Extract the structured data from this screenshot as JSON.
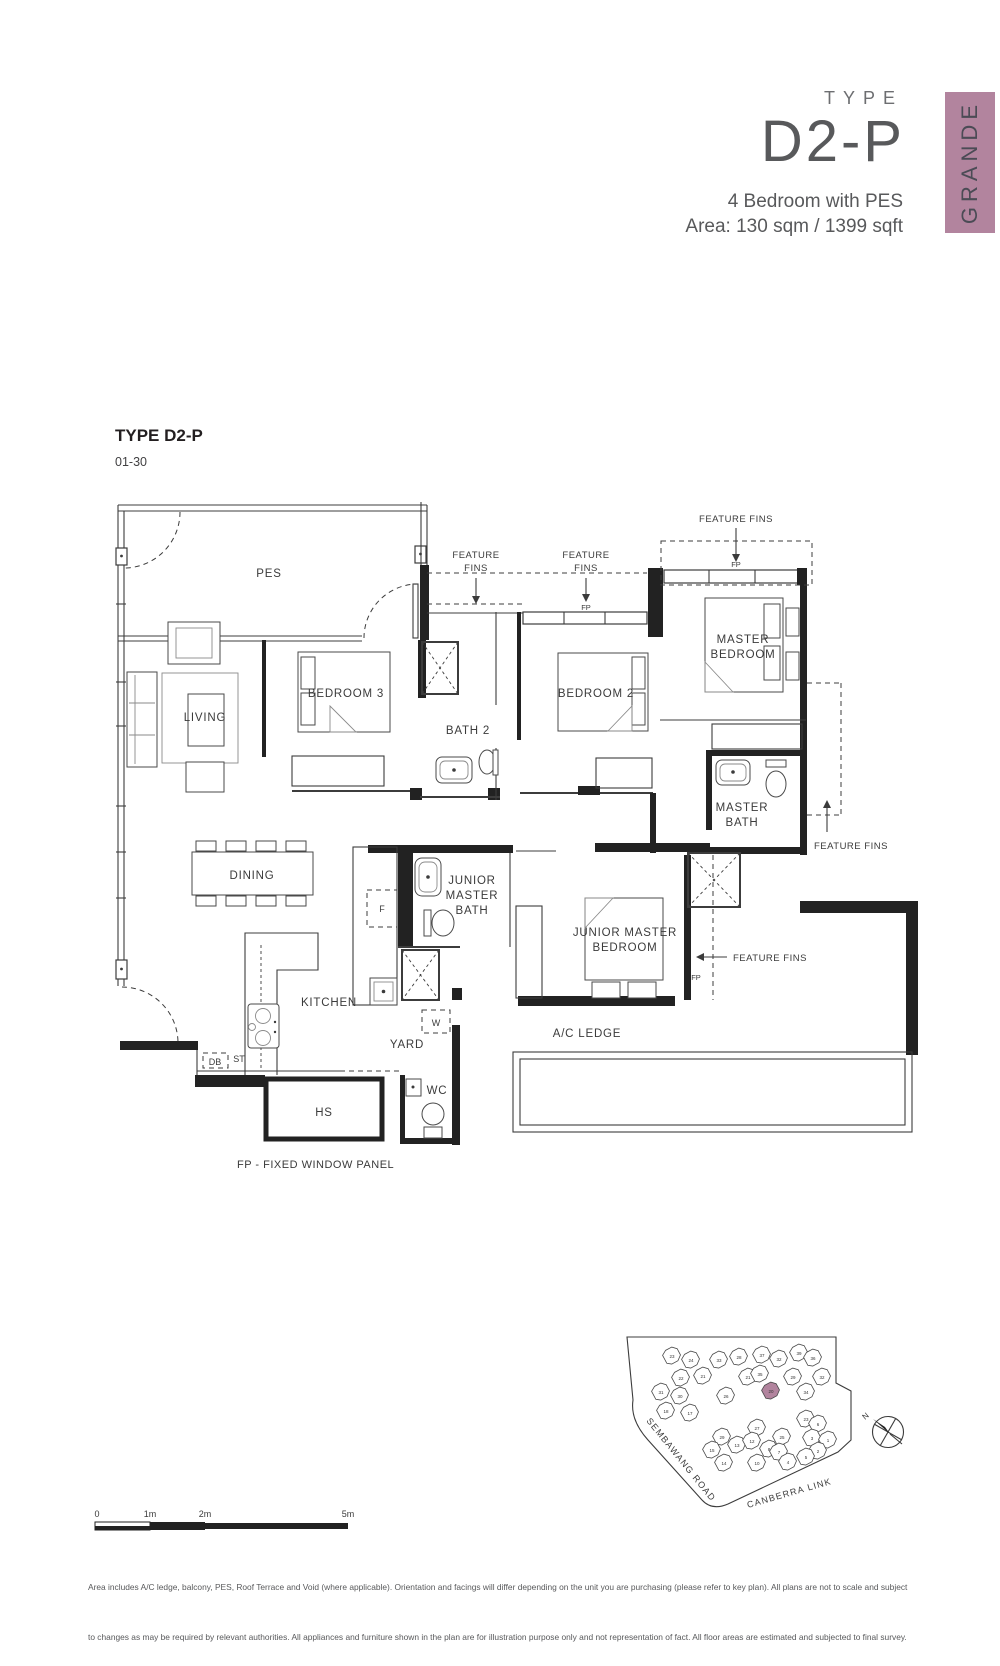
{
  "header": {
    "type_label": "TYPE",
    "unit_type": "D2-P",
    "subtitle": "4 Bedroom with PES",
    "area": "Area: 130 sqm / 1399 sqft",
    "brand": "GRANDE",
    "accent_color": "#b2849e"
  },
  "plan": {
    "title": "TYPE D2-P",
    "floors": "01-30",
    "note": "FP - FIXED WINDOW PANEL",
    "rooms": {
      "pes": "PES",
      "living": "LIVING",
      "dining": "DINING",
      "bedroom3": "BEDROOM 3",
      "bath2": "BATH 2",
      "bedroom2": "BEDROOM 2",
      "master_1": "MASTER",
      "master_2": "BEDROOM",
      "master_bath_1": "MASTER",
      "master_bath_2": "BATH",
      "jr_bath_1": "JUNIOR",
      "jr_bath_2": "MASTER",
      "jr_bath_3": "BATH",
      "jr_bed_1": "JUNIOR MASTER",
      "jr_bed_2": "BEDROOM",
      "kitchen": "KITCHEN",
      "yard": "YARD",
      "ac_ledge": "A/C LEDGE",
      "wc": "WC",
      "hs": "HS"
    },
    "tags": {
      "fp": "FP",
      "f": "F",
      "w": "W",
      "st": "ST",
      "db": "DB"
    },
    "feature_fins": {
      "line1": "FEATURE",
      "line2": "FINS",
      "single": "FEATURE FINS"
    }
  },
  "sitemap": {
    "road_left": "SEMBAWANG ROAD",
    "road_bottom": "CANBERRA LINK",
    "north": "N",
    "buildings": [
      {
        "n": "23",
        "x": 672,
        "y": 1356
      },
      {
        "n": "24",
        "x": 691,
        "y": 1360
      },
      {
        "n": "22",
        "x": 681,
        "y": 1378
      },
      {
        "n": "21",
        "x": 703,
        "y": 1376
      },
      {
        "n": "31",
        "x": 661,
        "y": 1392
      },
      {
        "n": "30",
        "x": 680,
        "y": 1396
      },
      {
        "n": "18",
        "x": 666,
        "y": 1411
      },
      {
        "n": "17",
        "x": 690,
        "y": 1413
      },
      {
        "n": "33",
        "x": 719,
        "y": 1360
      },
      {
        "n": "28",
        "x": 739,
        "y": 1357
      },
      {
        "n": "26",
        "x": 726,
        "y": 1396
      },
      {
        "n": "21",
        "x": 748,
        "y": 1377
      },
      {
        "n": "37",
        "x": 762,
        "y": 1355
      },
      {
        "n": "32",
        "x": 779,
        "y": 1359
      },
      {
        "n": "35",
        "x": 760,
        "y": 1374
      },
      {
        "n": "20",
        "x": 771,
        "y": 1391,
        "hl": true
      },
      {
        "n": "29",
        "x": 793,
        "y": 1377
      },
      {
        "n": "39",
        "x": 799,
        "y": 1353
      },
      {
        "n": "36",
        "x": 813,
        "y": 1358
      },
      {
        "n": "34",
        "x": 806,
        "y": 1392
      },
      {
        "n": "32",
        "x": 822,
        "y": 1377
      },
      {
        "n": "29",
        "x": 722,
        "y": 1437
      },
      {
        "n": "13",
        "x": 737,
        "y": 1445
      },
      {
        "n": "15",
        "x": 712,
        "y": 1450
      },
      {
        "n": "14",
        "x": 724,
        "y": 1463
      },
      {
        "n": "27",
        "x": 757,
        "y": 1428
      },
      {
        "n": "12",
        "x": 752,
        "y": 1441
      },
      {
        "n": "10",
        "x": 757,
        "y": 1463
      },
      {
        "n": "8",
        "x": 769,
        "y": 1449
      },
      {
        "n": "25",
        "x": 782,
        "y": 1437
      },
      {
        "n": "7",
        "x": 779,
        "y": 1452
      },
      {
        "n": "23",
        "x": 806,
        "y": 1419
      },
      {
        "n": "6",
        "x": 818,
        "y": 1424
      },
      {
        "n": "3",
        "x": 812,
        "y": 1438
      },
      {
        "n": "1",
        "x": 828,
        "y": 1440
      },
      {
        "n": "2",
        "x": 818,
        "y": 1451
      },
      {
        "n": "5",
        "x": 806,
        "y": 1457
      },
      {
        "n": "4",
        "x": 788,
        "y": 1462
      }
    ]
  },
  "scalebar": {
    "t0": "0",
    "t1": "1m",
    "t2": "2m",
    "t5": "5m"
  },
  "footer": {
    "line1": "Area includes A/C ledge, balcony, PES, Roof Terrace and Void (where applicable). Orientation and facings will differ depending on the unit you are purchasing (please refer to key plan). All plans are not to scale and subject",
    "line2": "to changes as may be required by relevant authorities. All appliances and furniture shown in the plan are for illustration purpose only and not representation of fact. All floor areas are estimated and subjected to final survey.",
    "legend": "Legend:     F - Fridge     DB - Distribution Board     ST - Storage space     WC - Water Closet     W - Washer     A/C - Aircon     PES - Private Enclosed Space     HS - Household Shelter"
  }
}
